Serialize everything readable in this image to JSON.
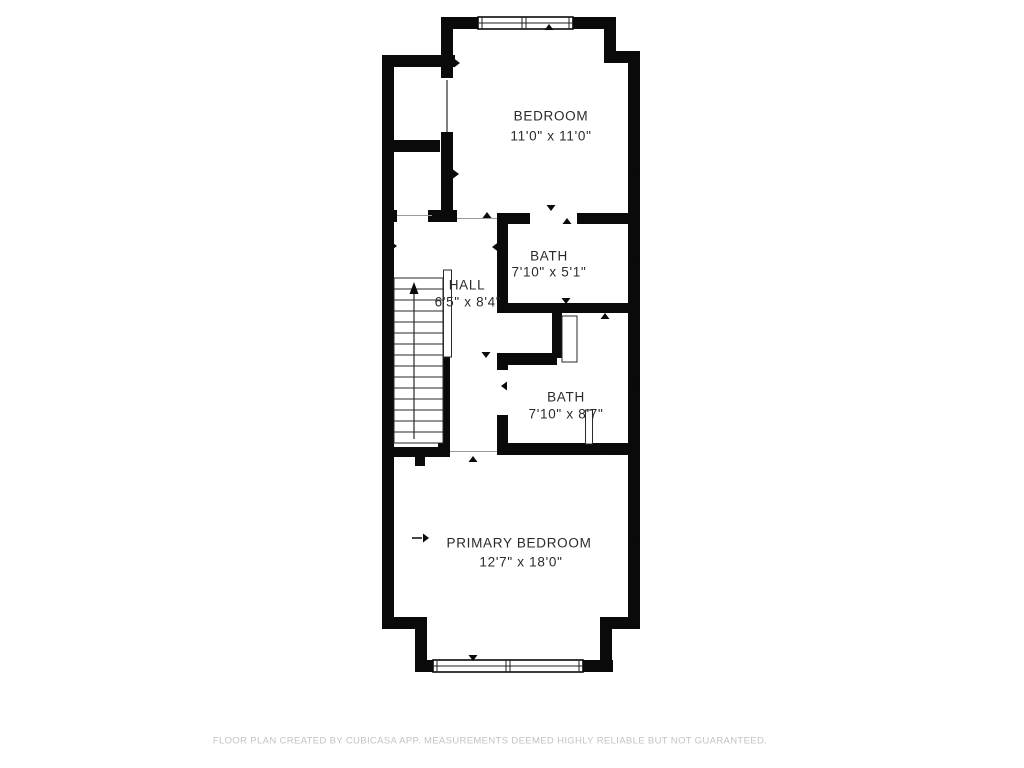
{
  "floorplan": {
    "rooms": {
      "bedroom": {
        "name": "BEDROOM",
        "dims": "11'0\" x 11'0\""
      },
      "bath_upper": {
        "name": "BATH",
        "dims": "7'10\" x 5'1\""
      },
      "hall": {
        "name": "HALL",
        "dims": "6'5\" x 8'4\""
      },
      "bath_lower": {
        "name": "BATH",
        "dims": "7'10\" x 8'7\""
      },
      "primary_bedroom": {
        "name": "PRIMARY BEDROOM",
        "dims": "12'7\" x 18'0\""
      }
    },
    "footer": "FLOOR PLAN CREATED BY CUBICASA APP. MEASUREMENTS DEEMED HIGHLY RELIABLE BUT NOT GUARANTEED.",
    "colors": {
      "wall": "#0a0a0a",
      "line": "#2a2a2a",
      "label": "#2a2a2a",
      "footer_text": "#c3c3c3",
      "background": "#ffffff"
    }
  }
}
